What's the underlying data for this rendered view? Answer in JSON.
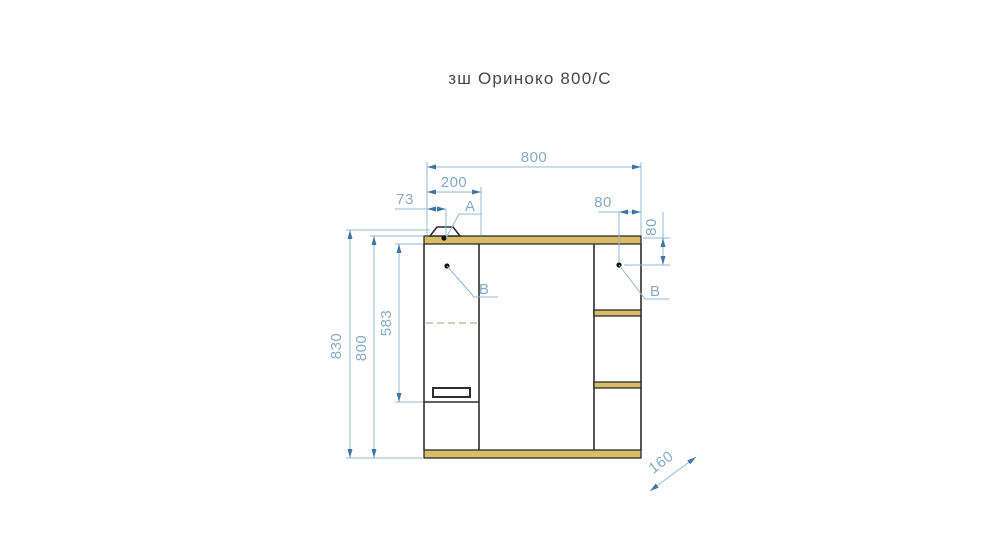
{
  "title": "зш Ориноко 800/С",
  "diagram": {
    "kind": "furniture technical drawing, front view of mirror cabinet",
    "product_name": "зш Ориноко 800/С",
    "dims": {
      "total_width": "800",
      "door_width": "200",
      "lamp_offset": "73",
      "shelf_point_from_right": "80",
      "shelf_point_from_top": "80",
      "total_height": "830",
      "body_height": "800",
      "door_height": "583",
      "depth": "160"
    },
    "callouts": {
      "lamp": "A",
      "door_point": "B",
      "shelf_point": "B"
    },
    "colors": {
      "dim_line": "#93b8d4",
      "dim_text": "#85aac8",
      "arrow": "#3f75a6",
      "outline": "#2d2d2d",
      "wood_edge_fill": "#d8bc66",
      "hidden_shelf_line": "#c9d3c0",
      "title_text": "#474747",
      "background": "#ffffff"
    }
  }
}
